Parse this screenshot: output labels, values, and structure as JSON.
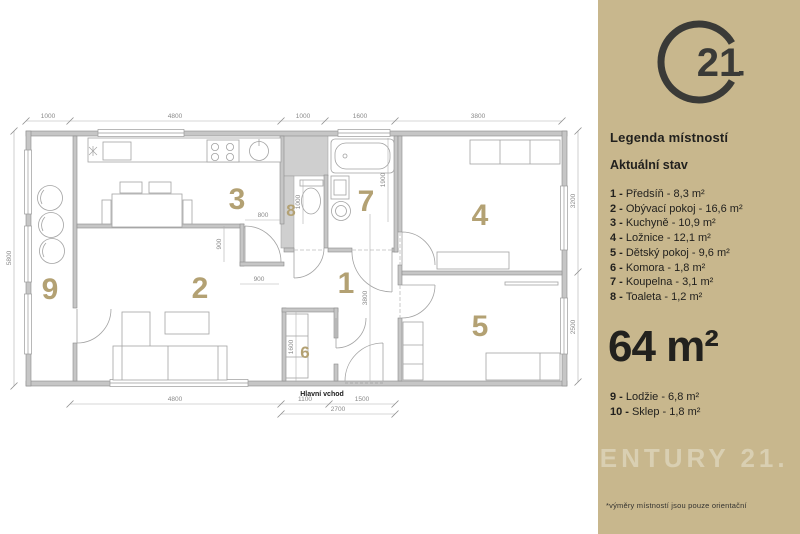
{
  "sidebar": {
    "bg_color": "#c8b78d",
    "logo": {
      "number": "21",
      "alt": "Century 21 logo",
      "color": "#3a3a37"
    },
    "legend_title": "Legenda místností",
    "status_title": "Aktuální stav",
    "rooms": [
      {
        "n": "1 -",
        "t": "Předsíň - 8,3 m²"
      },
      {
        "n": "2 -",
        "t": "Obývací pokoj - 16,6 m²"
      },
      {
        "n": "3 -",
        "t": "Kuchyně - 10,9 m²"
      },
      {
        "n": "4 -",
        "t": "Ložnice - 12,1 m²"
      },
      {
        "n": "5 -",
        "t": "Dětský pokoj - 9,6 m²"
      },
      {
        "n": "6 -",
        "t": "Komora - 1,8 m²"
      },
      {
        "n": "7 -",
        "t": "Koupelna - 3,1 m²"
      },
      {
        "n": "8 -",
        "t": "Toaleta - 1,2 m²"
      }
    ],
    "total_area": "64 m²",
    "extra_rooms": [
      {
        "n": "9 -",
        "t": "Lodžie - 6,8 m²"
      },
      {
        "n": "10 -",
        "t": "Sklep - 1,8 m²"
      }
    ],
    "watermark": "CENTURY 21.",
    "footnote": "*výměry místností jsou pouze orientační"
  },
  "plan": {
    "accent_color": "#b3a173",
    "wall_color": "#c6c6c6",
    "entrance_label": "Hlavní vchod",
    "room_numbers": {
      "hall": "1",
      "living": "2",
      "kitchen": "3",
      "bedroom": "4",
      "kids": "5",
      "storage": "6",
      "bath": "7",
      "wc": "8",
      "loggia": "9"
    },
    "dims": {
      "top": [
        "1000",
        "4800",
        "1000",
        "1600",
        "3800"
      ],
      "left": "5800",
      "right": [
        "3200",
        "2500"
      ],
      "bottom": [
        "4800",
        "1100",
        "1500",
        "2700"
      ],
      "inner": {
        "kitchen_door": "800",
        "step": "900",
        "passage": "900",
        "wc_depth": "1000",
        "bath_depth": "1900",
        "hall_depth": "3800",
        "storage_depth": "1600"
      }
    }
  }
}
